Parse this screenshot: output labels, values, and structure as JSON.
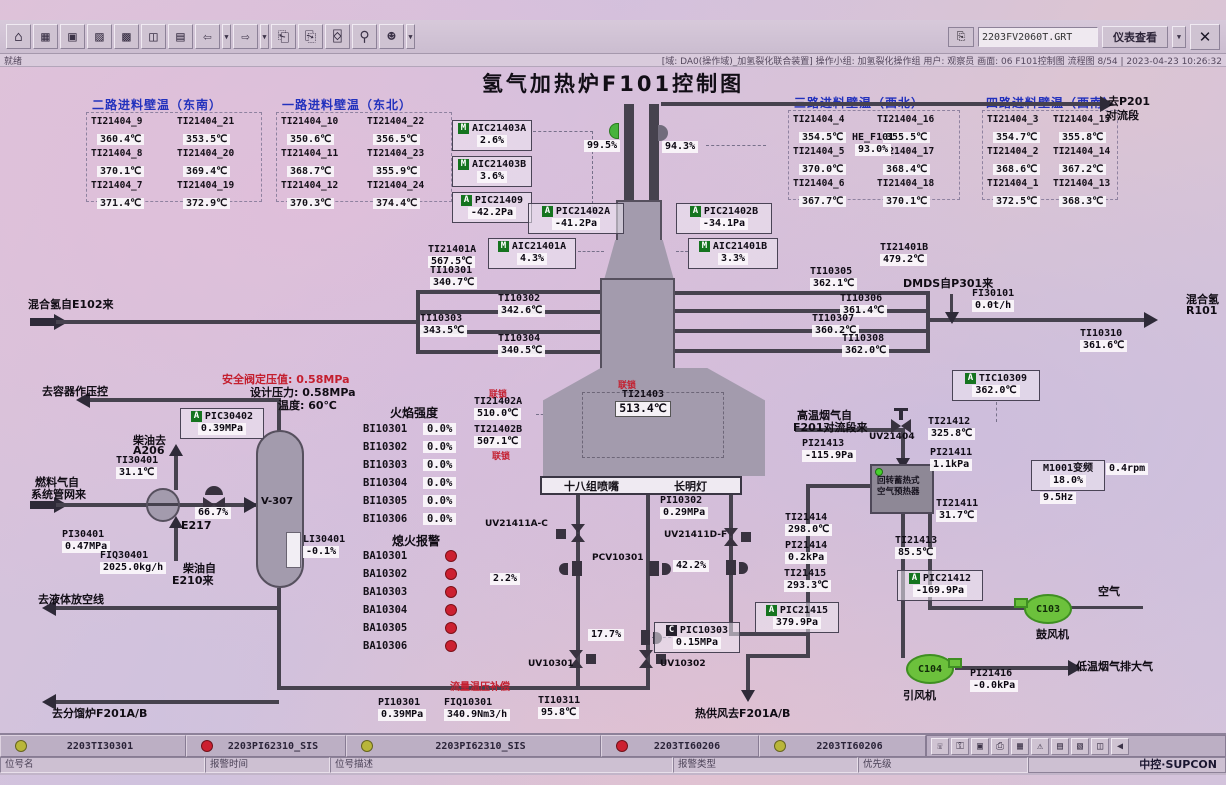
{
  "title": "氢气加热炉F101控制图",
  "toolbar": {
    "icons": [
      {
        "name": "home-icon",
        "glyph": "⌂"
      },
      {
        "name": "overview-icon",
        "glyph": "▦"
      },
      {
        "name": "screen-icon",
        "glyph": "▣"
      },
      {
        "name": "trend-icon",
        "glyph": "▨"
      },
      {
        "name": "matrix-icon",
        "glyph": "▩"
      },
      {
        "name": "faceplate-icon",
        "glyph": "◫"
      },
      {
        "name": "report-icon",
        "glyph": "▤"
      },
      {
        "name": "back-icon",
        "glyph": "⇦",
        "drop": true
      },
      {
        "name": "forward-icon",
        "glyph": "⇨",
        "drop": true
      },
      {
        "name": "prev-page-icon",
        "glyph": "⎗"
      },
      {
        "name": "next-page-icon",
        "glyph": "⎘"
      },
      {
        "name": "book-icon",
        "glyph": "⌺"
      },
      {
        "name": "search-icon",
        "glyph": "⚲"
      },
      {
        "name": "user-icon",
        "glyph": "☻",
        "drop": true
      }
    ],
    "screen_file": "2203FV2060T.GRT",
    "view_button": "仪表查看",
    "close_glyph": "✕"
  },
  "statusbar": {
    "ready": "就绪",
    "info": "[域: DA0(操作域)_加氢裂化联合装置]  操作小组: 加氢裂化操作组  用户: 观察员  画面: 06 F101控制图  流程图 8/54 | 2023-04-23 10:26:32"
  },
  "wall_panels": [
    {
      "title": "二路进料壁温（东南）",
      "cells": [
        [
          "TI21404_9",
          "360.4℃"
        ],
        [
          "TI21404_21",
          "353.5℃"
        ],
        [
          "TI21404_8",
          "370.1℃"
        ],
        [
          "TI21404_20",
          "369.4℃"
        ],
        [
          "TI21404_7",
          "371.4℃"
        ],
        [
          "TI21404_19",
          "372.9℃"
        ]
      ]
    },
    {
      "title": "一路进料壁温（东北）",
      "cells": [
        [
          "TI21404_10",
          "350.6℃"
        ],
        [
          "TI21404_22",
          "356.5℃"
        ],
        [
          "TI21404_11",
          "368.7℃"
        ],
        [
          "TI21404_23",
          "355.9℃"
        ],
        [
          "TI21404_12",
          "370.3℃"
        ],
        [
          "TI21404_24",
          "374.4℃"
        ]
      ]
    },
    {
      "title": "三路进料壁温（西北）",
      "cells": [
        [
          "TI21404_4",
          "354.5℃"
        ],
        [
          "TI21404_16",
          "355.5℃"
        ],
        [
          "TI21404_5",
          "370.0℃"
        ],
        [
          "TI21404_17",
          "368.4℃"
        ],
        [
          "TI21404_6",
          "367.7℃"
        ],
        [
          "TI21404_18",
          "370.1℃"
        ]
      ]
    },
    {
      "title": "四路进料壁温（西南）",
      "cells": [
        [
          "TI21404_3",
          "354.7℃"
        ],
        [
          "TI21404_15",
          "355.8℃"
        ],
        [
          "TI21404_2",
          "368.6℃"
        ],
        [
          "TI21404_14",
          "367.2℃"
        ],
        [
          "TI21404_1",
          "372.5℃"
        ],
        [
          "TI21404_13",
          "368.3℃"
        ]
      ]
    }
  ],
  "instruments": {
    "aic21403a": {
      "b": "M",
      "l": "AIC21403A",
      "v": "2.6%"
    },
    "aic21403b": {
      "b": "M",
      "l": "AIC21403B",
      "v": "3.6%"
    },
    "pic21409": {
      "b": "A",
      "l": "PIC21409",
      "v": "-42.2Pa"
    },
    "d99": {
      "v": "99.5%"
    },
    "d94": {
      "v": "94.3%"
    },
    "he_f101": {
      "l": "HE_F101",
      "v": "93.0%"
    },
    "pic21402a": {
      "b": "A",
      "l": "PIC21402A",
      "v": "-41.2Pa"
    },
    "pic21402b": {
      "b": "A",
      "l": "PIC21402B",
      "v": "-34.1Pa"
    },
    "ti21401a": {
      "l": "TI21401A",
      "v": "567.5℃"
    },
    "aic21401a": {
      "b": "M",
      "l": "AIC21401A",
      "v": "4.3%"
    },
    "aic21401b": {
      "b": "M",
      "l": "AIC21401B",
      "v": "3.3%"
    },
    "ti21401b": {
      "l": "TI21401B",
      "v": "479.2℃"
    },
    "ti10301": {
      "l": "TI10301",
      "v": "340.7℃"
    },
    "ti10302": {
      "l": "TI10302",
      "v": "342.6℃"
    },
    "ti10303": {
      "l": "TI10303",
      "v": "343.5℃"
    },
    "ti10304": {
      "l": "TI10304",
      "v": "340.5℃"
    },
    "ti10305": {
      "l": "TI10305",
      "v": "362.1℃"
    },
    "ti10306": {
      "l": "TI10306",
      "v": "361.4℃"
    },
    "ti10307": {
      "l": "TI10307",
      "v": "360.2℃"
    },
    "ti10308": {
      "l": "TI10308",
      "v": "362.0℃"
    },
    "fi30101": {
      "l": "FI30101",
      "v": "0.0t/h"
    },
    "ti10310": {
      "l": "TI10310",
      "v": "361.6℃"
    },
    "tic10309": {
      "b": "A",
      "l": "TIC10309",
      "v": "362.0℃"
    },
    "ti21402a": {
      "l": "TI21402A",
      "v": "510.0℃"
    },
    "ti21402b": {
      "l": "TI21402B",
      "v": "507.1℃"
    },
    "ti21403": {
      "l": "TI21403",
      "v": "513.4℃"
    },
    "v22": {
      "v": "2.2%"
    },
    "v177": {
      "v": "17.7%"
    },
    "v422": {
      "v": "42.2%"
    },
    "v667": {
      "v": "66.7%"
    },
    "pic10303": {
      "b": "C",
      "l": "PIC10303",
      "v": "0.15MPa"
    },
    "pi10302": {
      "l": "PI10302",
      "v": "0.29MPa"
    },
    "pi10301": {
      "l": "PI10301",
      "v": "0.39MPa"
    },
    "fiq10301": {
      "l": "FIQ10301",
      "v": "340.9Nm3/h"
    },
    "ti10311": {
      "l": "TI10311",
      "v": "95.8℃"
    },
    "ti21412": {
      "l": "TI21412",
      "v": "325.8℃"
    },
    "pi21413": {
      "l": "PI21413",
      "v": "-115.9Pa"
    },
    "pi21411": {
      "l": "PI21411",
      "v": "1.1kPa"
    },
    "m1001": {
      "l": "M1001变频",
      "v": "18.0%"
    },
    "m1001_hz": {
      "v": "9.5Hz"
    },
    "m1001_rpm": {
      "v": "0.4rpm"
    },
    "ti21411": {
      "l": "TI21411",
      "v": "31.7℃"
    },
    "ti21414": {
      "l": "TI21414",
      "v": "298.0℃"
    },
    "pi21414": {
      "l": "PI21414",
      "v": "0.2kPa"
    },
    "ti21415": {
      "l": "TI21415",
      "v": "293.3℃"
    },
    "pic21415": {
      "b": "A",
      "l": "PIC21415",
      "v": "379.9Pa"
    },
    "ti21413": {
      "l": "TI21413",
      "v": "85.5℃"
    },
    "pic21412": {
      "b": "A",
      "l": "PIC21412",
      "v": "-169.9Pa"
    },
    "pi21416": {
      "l": "PI21416",
      "v": "-0.0kPa"
    },
    "pic30402": {
      "b": "A",
      "l": "PIC30402",
      "v": "0.39MPa"
    },
    "ti30401": {
      "l": "TI30401",
      "v": "31.1℃"
    },
    "pi30401": {
      "l": "PI30401",
      "v": "0.47MPa"
    },
    "fiq30401": {
      "l": "FIQ30401",
      "v": "2025.0kg/h"
    },
    "li30401": {
      "l": "LI30401",
      "v": "-0.1%"
    }
  },
  "flame": {
    "title": "火焰强度",
    "rows": [
      [
        "BI10301",
        "0.0%"
      ],
      [
        "BI10302",
        "0.0%"
      ],
      [
        "BI10303",
        "0.0%"
      ],
      [
        "BI10304",
        "0.0%"
      ],
      [
        "BI10305",
        "0.0%"
      ],
      [
        "BI10306",
        "0.0%"
      ]
    ]
  },
  "flameout": {
    "title": "熄火报警",
    "rows": [
      "BA10301",
      "BA10302",
      "BA10303",
      "BA10304",
      "BA10305",
      "BA10306"
    ]
  },
  "labels": {
    "to_p201_1": "去P201",
    "to_p201_2": "对流段",
    "mix_h2_from": "混合氢自E102来",
    "dmds_from": "DMDS自P301来",
    "mix_h2": "混合氢",
    "r101": "R101",
    "interlock": "联锁",
    "nozzles": "十八组喷嘴",
    "pilot": "长明灯",
    "comp": "流量温压补偿",
    "hot_air_out": "热供风去F201A/B",
    "hot_flue1": "高温烟气自",
    "hot_flue2": "F201对流段来",
    "ph1": "回转蓄热式",
    "ph2": "空气预热器",
    "blower": "鼓风机",
    "id_fan": "引风机",
    "air": "空气",
    "cold_flue": "低温烟气排大气",
    "to_vessel": "去容器作压控",
    "sv_set": "安全阀定压值: 0.58MPa",
    "design_p": "设计压力: 0.58MPa",
    "design_t": "温度: 60℃",
    "diesel_to": "柴油去",
    "a206": "A206",
    "fuel1": "燃料气自",
    "fuel2": "系统管网来",
    "e217": "E217",
    "v307": "V-307",
    "diesel_from1": "柴油自",
    "diesel_from2": "E210来",
    "to_drain": "去液体放空线",
    "to_f201": "去分馏炉F201A/B",
    "uv21411ac": "UV21411A-C",
    "pcv10301": "PCV10301",
    "uv21411df": "UV21411D-F",
    "uv10301": "UV10301",
    "uv10302": "UV10302",
    "uv21404": "UV21404",
    "c103": "C103",
    "c104": "C104"
  },
  "alarm_bar": {
    "entries": [
      {
        "color": "#b9b63a",
        "tag": "2203TI30301"
      },
      {
        "color": "#cc2030",
        "tag": "2203PI62310_SIS"
      },
      {
        "color": "#b9b63a",
        "tag": "2203PI62310_SIS"
      },
      {
        "color": "#cc2030",
        "tag": "2203TI60206"
      },
      {
        "color": "#b9b63a",
        "tag": "2203TI60206"
      }
    ],
    "fields": [
      "位号名",
      "报警时间",
      "位号描述",
      "报警类型",
      "优先级"
    ],
    "icons": [
      {
        "name": "phone-icon",
        "glyph": "☏"
      },
      {
        "name": "lock-icon",
        "glyph": "⚿"
      },
      {
        "name": "monitor-icon",
        "glyph": "▣"
      },
      {
        "name": "printer-icon",
        "glyph": "⎙"
      },
      {
        "name": "keypad-icon",
        "glyph": "▦"
      },
      {
        "name": "alarm-bell-icon",
        "glyph": "⚠"
      },
      {
        "name": "list-icon",
        "glyph": "▤"
      },
      {
        "name": "document-icon",
        "glyph": "▧"
      },
      {
        "name": "layout-icon",
        "glyph": "◫"
      },
      {
        "name": "horn-icon",
        "glyph": "◀"
      }
    ],
    "brand": "中控·SUPCON"
  }
}
